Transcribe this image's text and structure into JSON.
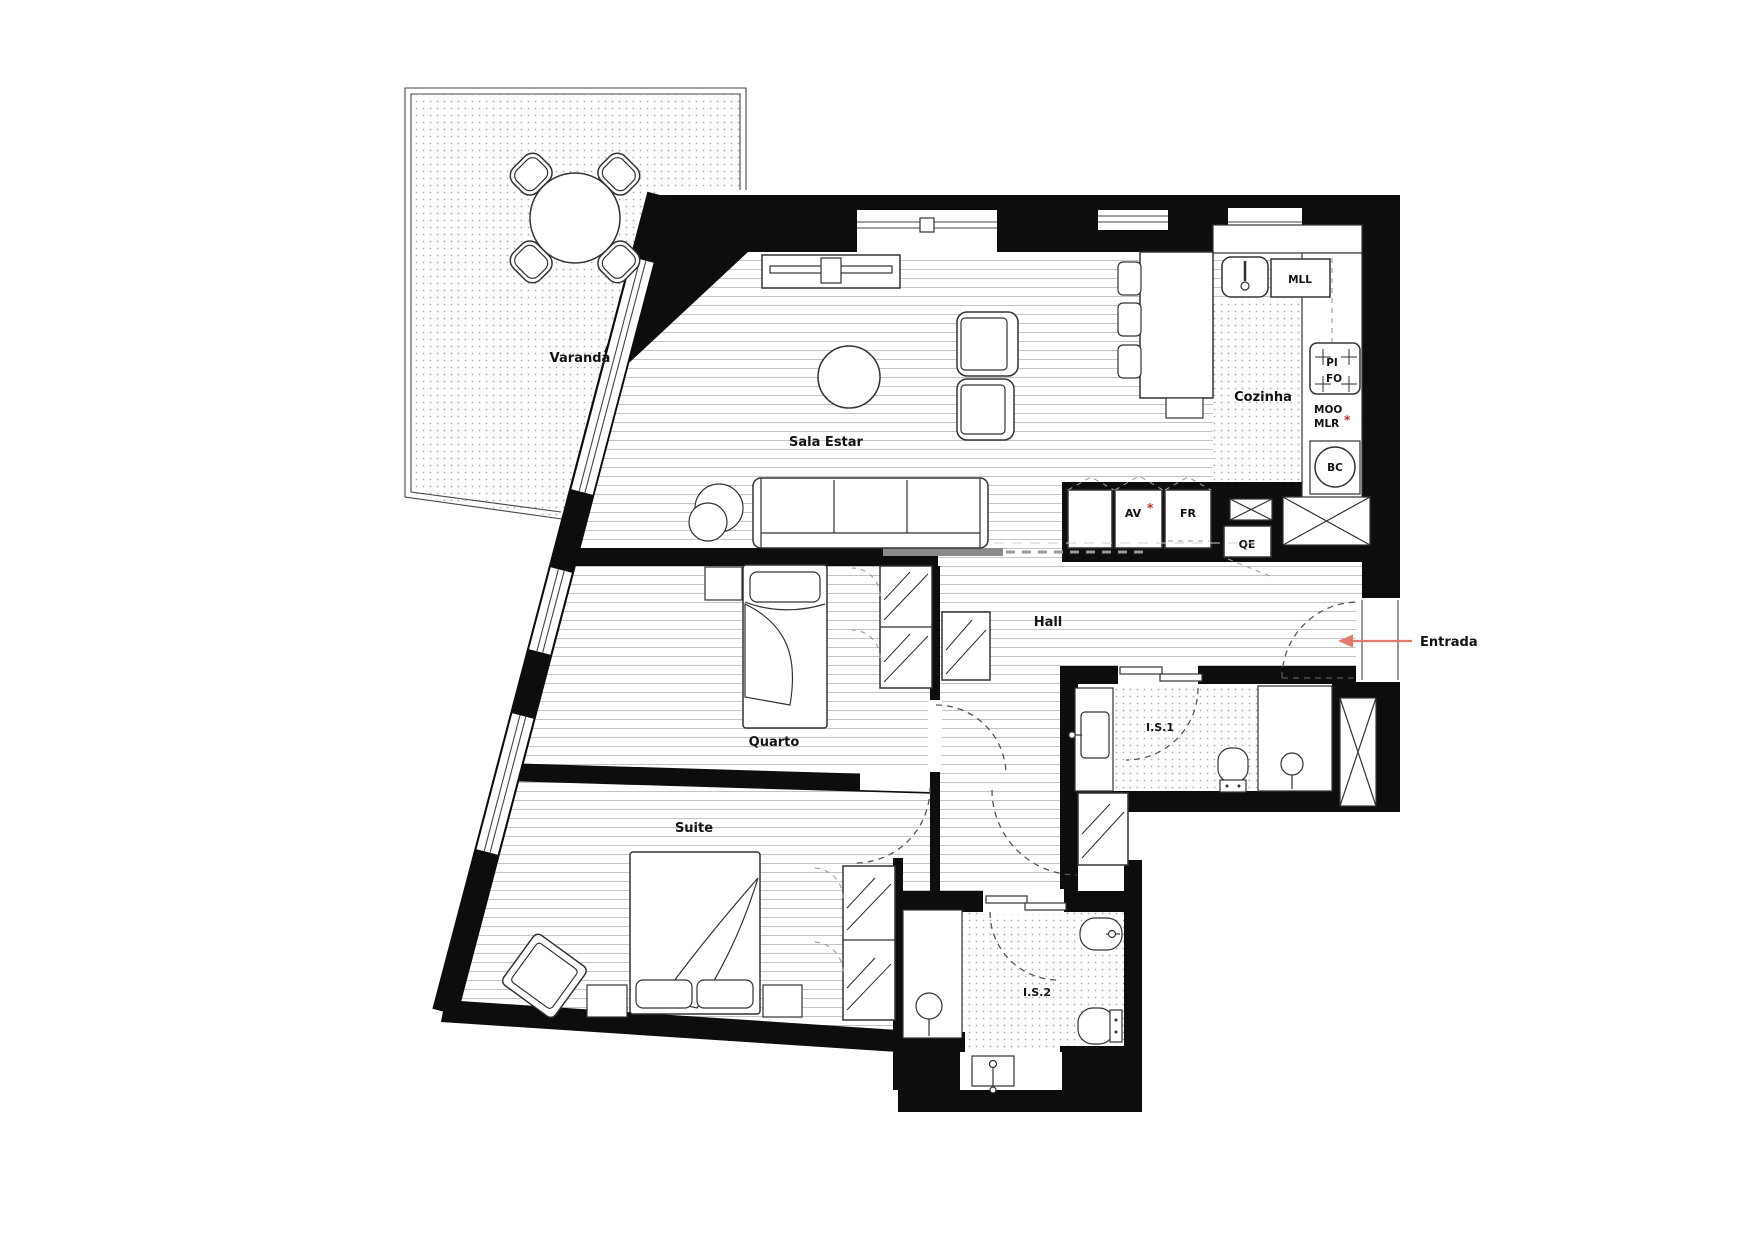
{
  "title": "Apartment floor plan",
  "colors": {
    "wall": "#0d0d0d",
    "floor_line": "#c4c4c4",
    "tile_dot": "#adadad",
    "furniture_line": "#333333",
    "door_dash": "#555555",
    "entry_arrow": "#e07b6e",
    "red_mark": "#c12a22"
  },
  "rooms": {
    "varanda": {
      "label": "Varanda"
    },
    "sala_estar": {
      "label": "Sala Estar"
    },
    "cozinha": {
      "label": "Cozinha"
    },
    "hall": {
      "label": "Hall"
    },
    "quarto": {
      "label": "Quarto"
    },
    "suite": {
      "label": "Suite"
    },
    "is1": {
      "label": "I.S.1"
    },
    "is2": {
      "label": "I.S.2"
    }
  },
  "annotations": {
    "entrada": {
      "label": "Entrada"
    },
    "asterisk": "*",
    "appliances": {
      "mll": "MLL",
      "pi": "PI",
      "fo": "FO",
      "moo": "MOO",
      "mlr": "MLR",
      "av": "AV",
      "fr": "FR",
      "qe": "QE",
      "bc": "BC"
    }
  }
}
